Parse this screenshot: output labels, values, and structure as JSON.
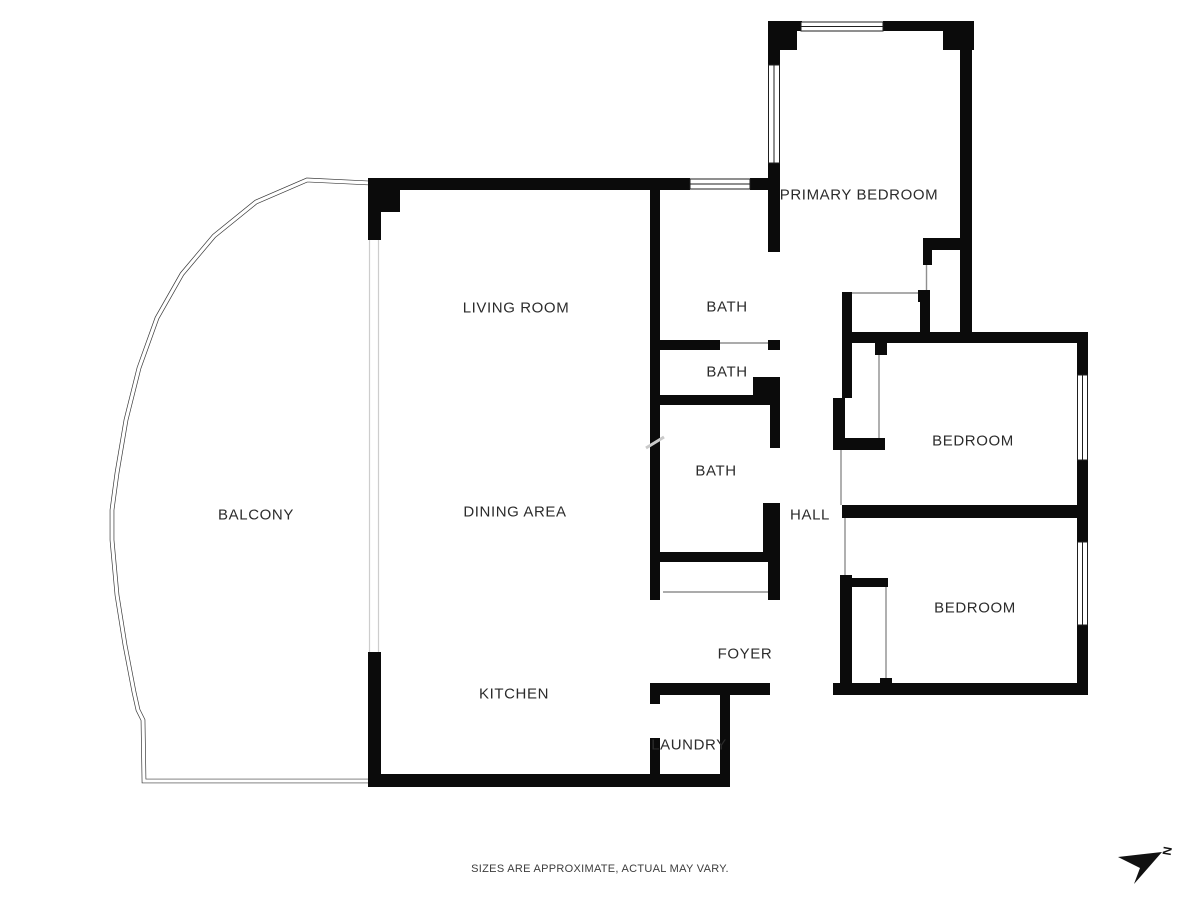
{
  "plan": {
    "rooms": {
      "primary_bedroom": {
        "label": "PRIMARY BEDROOM"
      },
      "living_room": {
        "label": "LIVING ROOM"
      },
      "dining_area": {
        "label": "DINING AREA"
      },
      "kitchen": {
        "label": "KITCHEN"
      },
      "balcony": {
        "label": "BALCONY"
      },
      "bath_1": {
        "label": "BATH"
      },
      "bath_2": {
        "label": "BATH"
      },
      "bath_3": {
        "label": "BATH"
      },
      "hall": {
        "label": "HALL"
      },
      "foyer": {
        "label": "FOYER"
      },
      "laundry": {
        "label": "LAUNDRY"
      },
      "bedroom_1": {
        "label": "BEDROOM"
      },
      "bedroom_2": {
        "label": "BEDROOM"
      }
    },
    "disclaimer": "SIZES ARE APPROXIMATE, ACTUAL MAY VARY.",
    "compass": {
      "letter": "N"
    },
    "colors": {
      "wall": "#0b0b0b",
      "thin_line": "#8f8f8f",
      "balcony_line": "#3a3a3a",
      "glass_line": "#cdcdcd",
      "text": "#2b2b2b"
    }
  }
}
